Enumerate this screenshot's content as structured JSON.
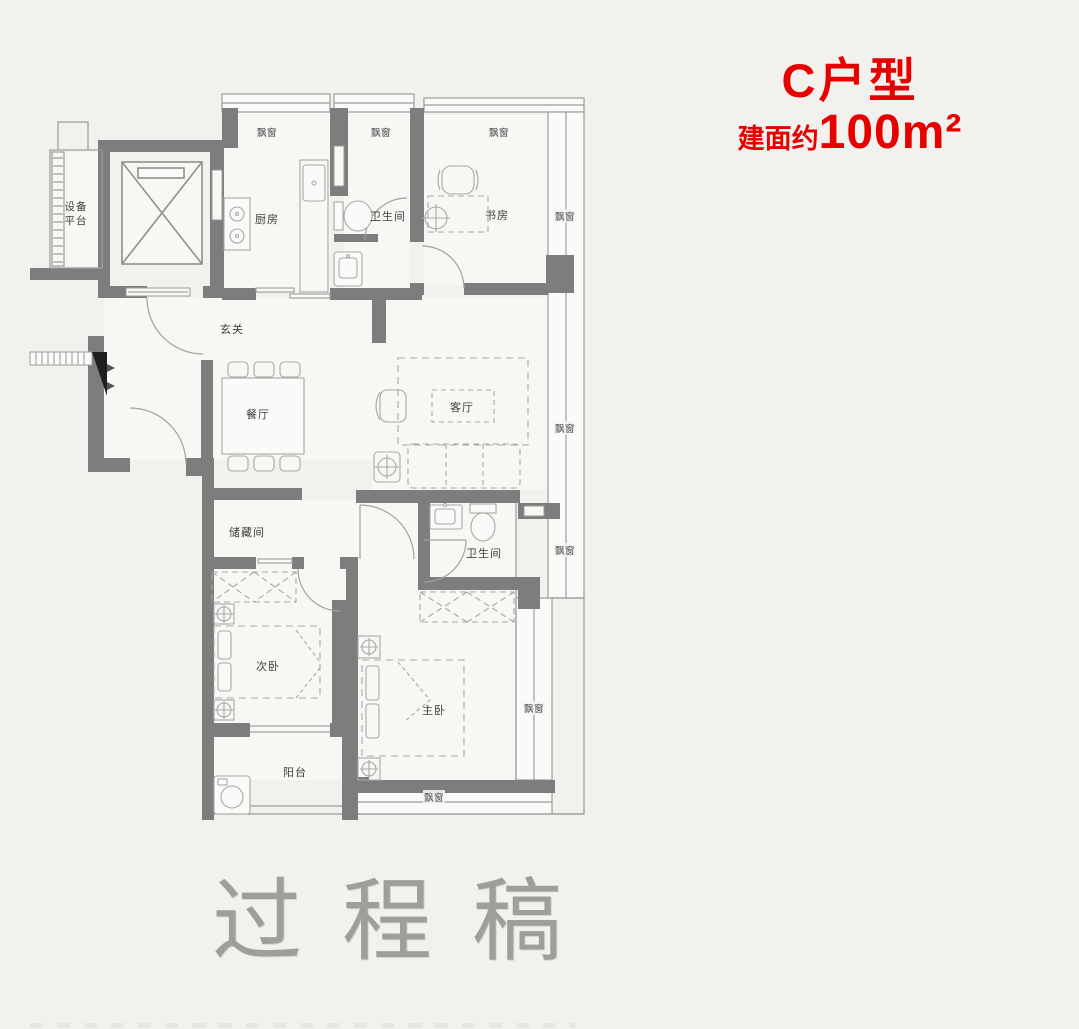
{
  "header": {
    "unit_name": "C户型",
    "area_prefix": "建面约",
    "area_value": "100m²"
  },
  "watermark": {
    "text": "过程稿"
  },
  "labels": {
    "bay_window": "飘窗"
  },
  "rooms": {
    "equipment_platform": "设备平台",
    "kitchen": "厨房",
    "bathroom_top": "卫生间",
    "study": "书房",
    "entry": "玄关",
    "dining": "餐厅",
    "living": "客厅",
    "storage": "储藏间",
    "bathroom_mid": "卫生间",
    "second_bedroom": "次卧",
    "master_bedroom": "主卧",
    "balcony": "阳台"
  },
  "colors": {
    "accent_red": "#e70000",
    "wall_gray": "#7d7d7d",
    "background": "#f2f1ed",
    "watermark_gray": "#9e9e9c"
  }
}
